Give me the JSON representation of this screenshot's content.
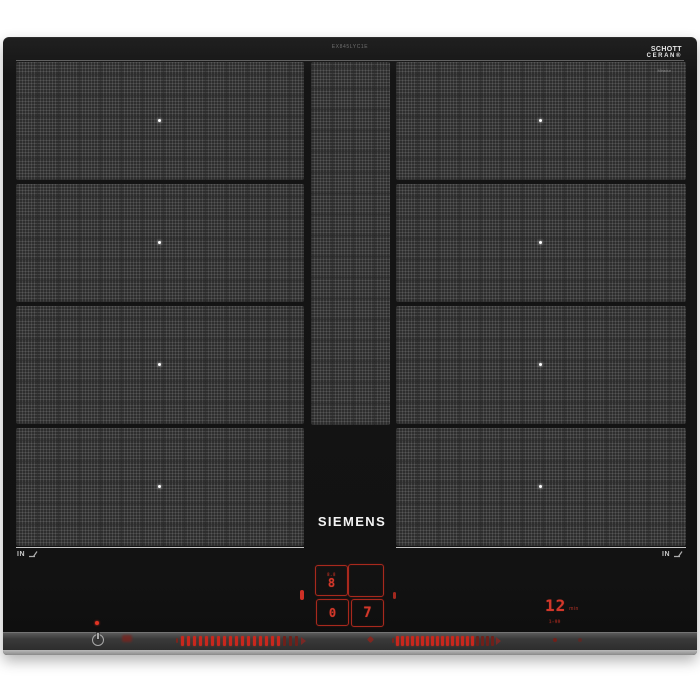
{
  "product": {
    "brand": "SIEMENS",
    "model_code": "EX845LYC1E",
    "glass_logo": {
      "line1": "SCHOTT",
      "line2": "CERAN®",
      "subline": "Miradur"
    },
    "induction_mark_left": "IN",
    "induction_mark_right": "IN"
  },
  "zones": {
    "left_count": 4,
    "right_count": 4,
    "center_dot_color": "#ffffff",
    "description": "flex induction cooking zones with woven texture"
  },
  "displays": {
    "left_top": {
      "value": "8",
      "sub_label": "8.8"
    },
    "left_bottom": {
      "value": "0"
    },
    "right_top": {
      "value": ""
    },
    "right_bottom": {
      "value": "7"
    },
    "timer": {
      "value": "12",
      "unit": "min",
      "sub_label": "1-99"
    }
  },
  "controls": {
    "power_button_icon": "power-standby-icon",
    "lock_indicator_icon": "key-lock-indicator",
    "left_slider": {
      "bright_bars": 17,
      "dim_bars": 3
    },
    "right_slider": {
      "bright_bars": 16,
      "dim_bars": 4
    },
    "separator_icon": "diamond-indicator",
    "status_dot_color": "#e23423"
  },
  "colors": {
    "display_red": "#d2372a",
    "bar_red_bright": "#c8271d",
    "bar_red_dim": "#6e201a",
    "glass_black": "#141414",
    "strip_gray": "#3a3a3a"
  }
}
